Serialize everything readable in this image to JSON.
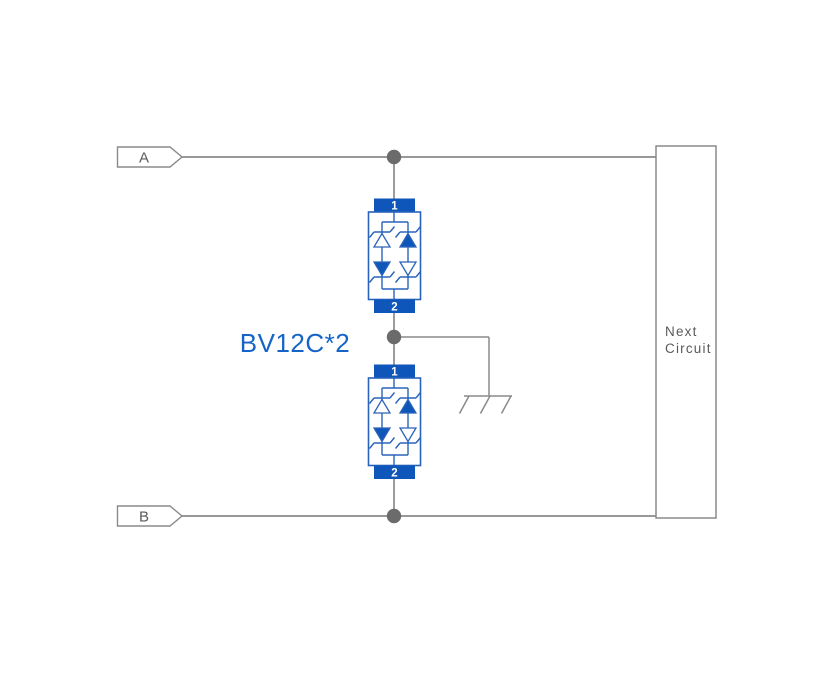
{
  "diagram_label": "BV12C*2",
  "terminals": {
    "a": "A",
    "b": "B"
  },
  "next_circuit": {
    "line1": "Next",
    "line2": "Circuit"
  },
  "components": [
    {
      "pin_top": "1",
      "pin_bottom": "2"
    },
    {
      "pin_top": "1",
      "pin_bottom": "2"
    }
  ],
  "colors": {
    "component-blue": "#0e56ba",
    "component-outline": "#2a63ba",
    "label-blue": "#1565c8",
    "wire-gray": "#8a8a8a",
    "text-gray": "#5a5a5a",
    "dot-gray": "#6b6b6b",
    "background": "#ffffff"
  }
}
